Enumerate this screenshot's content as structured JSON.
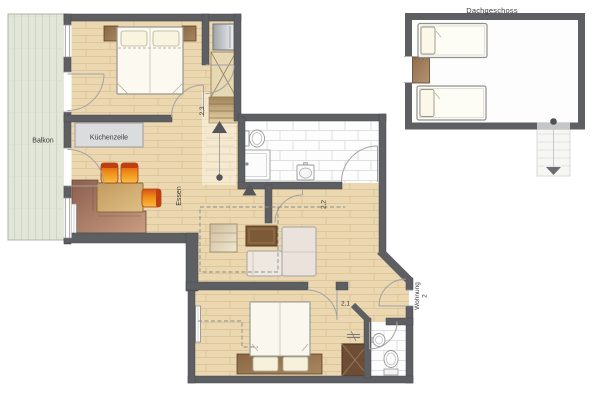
{
  "plan": {
    "attic_label": "Dachgeschoss",
    "balcony_label": "Balkon",
    "kitchenette_label": "Küchenzeile",
    "dining_label": "Essen",
    "entrance_line1": "Wohnung",
    "entrance_line2": "2",
    "room_hall": "2,3",
    "room_middle": "2,2",
    "room_bottom": "2,1"
  },
  "colors": {
    "wall": "#5e5f62",
    "floor": "#ebd8b1",
    "floor_line": "#d9bf92",
    "hall_floor": "#f7efdd",
    "balcony_deck": "#e2e6d9",
    "tile_line": "#d9dddf",
    "chair_orange": "#ef8c15",
    "sofa_brown": "#8c5f4e",
    "wood_brown": "#8a6646",
    "text": "#3b3b3b"
  }
}
